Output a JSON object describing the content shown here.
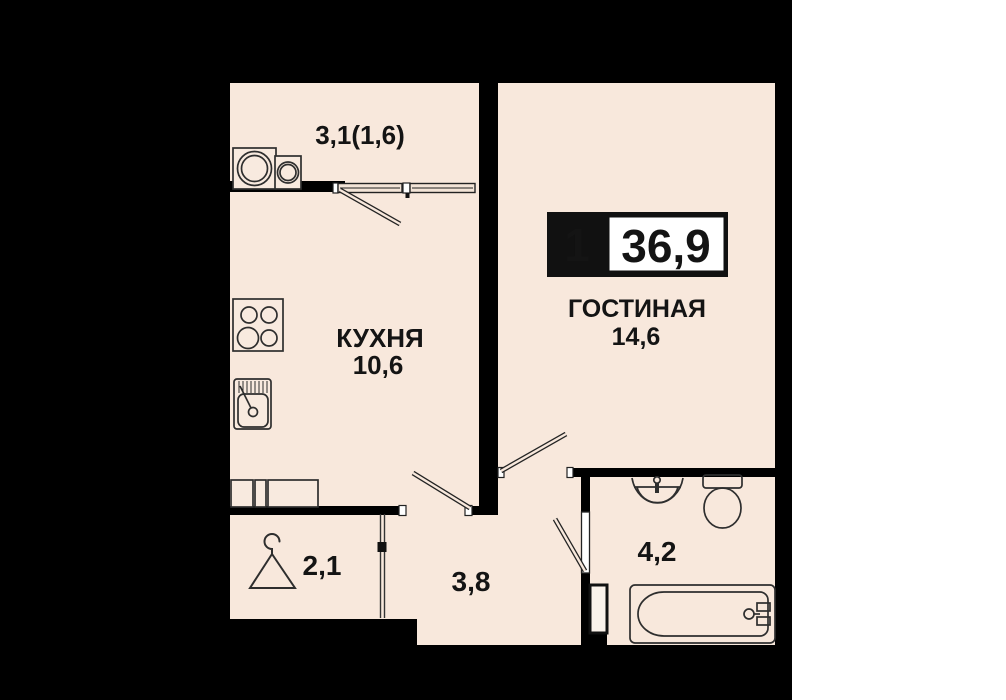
{
  "plan": {
    "badge": {
      "rooms_count": "1",
      "total_area": "36,9"
    },
    "rooms": {
      "balcony": {
        "area": "3,1(1,6)"
      },
      "kitchen": {
        "name": "КУХНЯ",
        "area": "10,6"
      },
      "living": {
        "name": "ГОСТИНАЯ",
        "area": "14,6"
      },
      "wardrobe": {
        "area": "2,1"
      },
      "hallway": {
        "area": "3,8"
      },
      "bathroom": {
        "area": "4,2"
      }
    },
    "colors": {
      "matte_background": "#000000",
      "page_background": "#ffffff",
      "floor": "#f8e8dc",
      "wall": "#000000",
      "furniture_line": "#2e2e2e",
      "text": "#141414",
      "badge_background": "#111111",
      "badge_panel": "#ffffff"
    }
  }
}
